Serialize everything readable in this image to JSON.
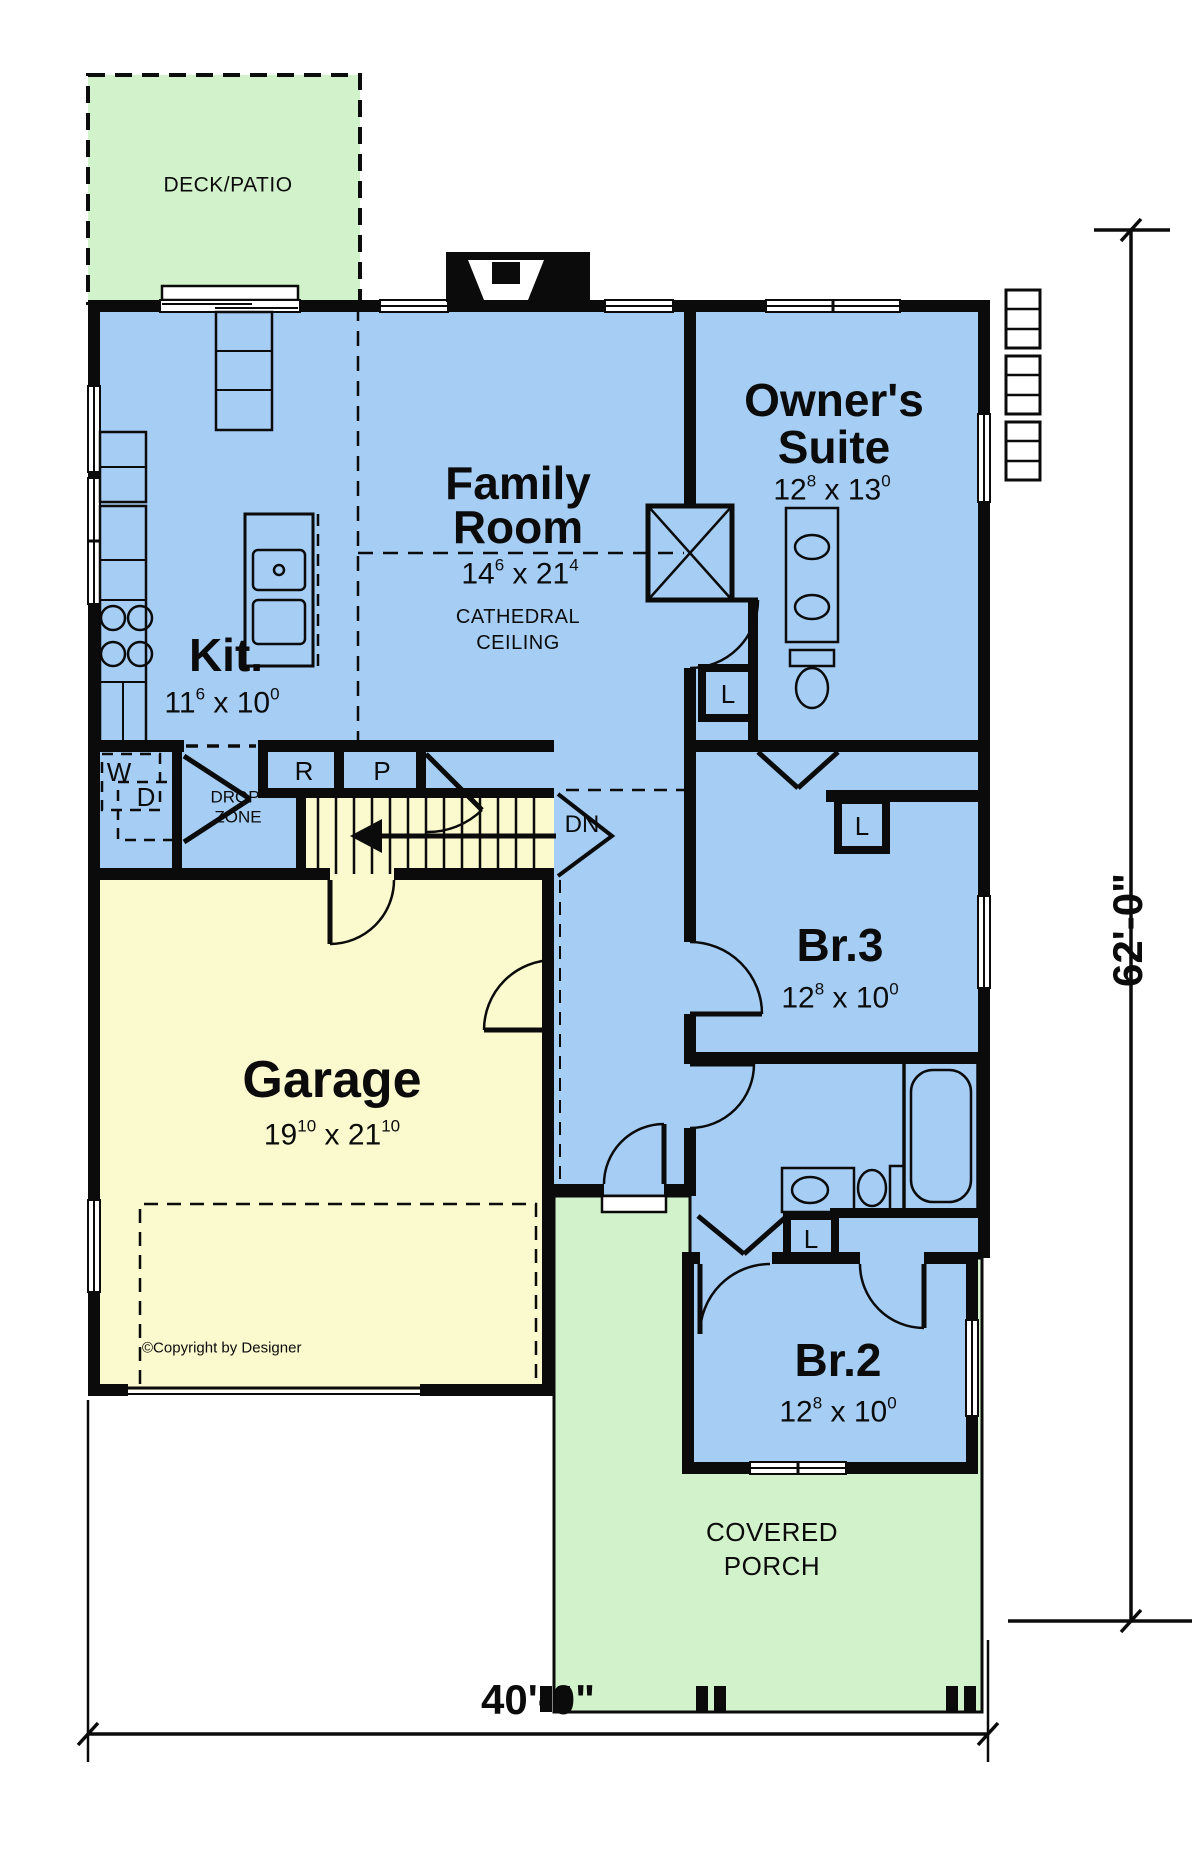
{
  "plan": {
    "rooms": {
      "deck": {
        "label": "DECK/PATIO"
      },
      "family": {
        "line1": "Family",
        "line2": "Room",
        "dim": {
          "a": "14",
          "asup": "6",
          "x": " x ",
          "b": "21",
          "bsup": "4"
        },
        "note1": "CATHEDRAL",
        "note2": "CEILING"
      },
      "owners": {
        "line1": "Owner's",
        "line2": "Suite",
        "dim": {
          "a": "12",
          "asup": "8",
          "x": " x ",
          "b": "13",
          "bsup": "0"
        }
      },
      "kitchen": {
        "label": "Kit.",
        "dim": {
          "a": "11",
          "asup": "6",
          "x": " x ",
          "b": "10",
          "bsup": "0"
        }
      },
      "garage": {
        "label": "Garage",
        "dim": {
          "a": "19",
          "asup": "10",
          "x": " x ",
          "b": "21",
          "bsup": "10"
        }
      },
      "br3": {
        "label": "Br.3",
        "dim": {
          "a": "12",
          "asup": "8",
          "x": " x ",
          "b": "10",
          "bsup": "0"
        }
      },
      "br2": {
        "label": "Br.2",
        "dim": {
          "a": "12",
          "asup": "8",
          "x": " x ",
          "b": "10",
          "bsup": "0"
        }
      },
      "porch": {
        "line1": "COVERED",
        "line2": "PORCH"
      }
    },
    "closets": {
      "washer": "W",
      "dryer": "D",
      "drop1": "DROP",
      "drop2": "ZONE",
      "range": "R",
      "pantry": "P",
      "linen": "L"
    },
    "stairs": {
      "down": "DN"
    },
    "dimensions": {
      "depth": "62'-0\"",
      "width": "40'-0\""
    },
    "copyright": "©Copyright by Designer",
    "colors": {
      "room_blue": "#A6CEF5",
      "garage_cream": "#FBF9CE",
      "outdoor_green": "#D2F2CB",
      "wall_black": "#0B0B0B"
    }
  }
}
